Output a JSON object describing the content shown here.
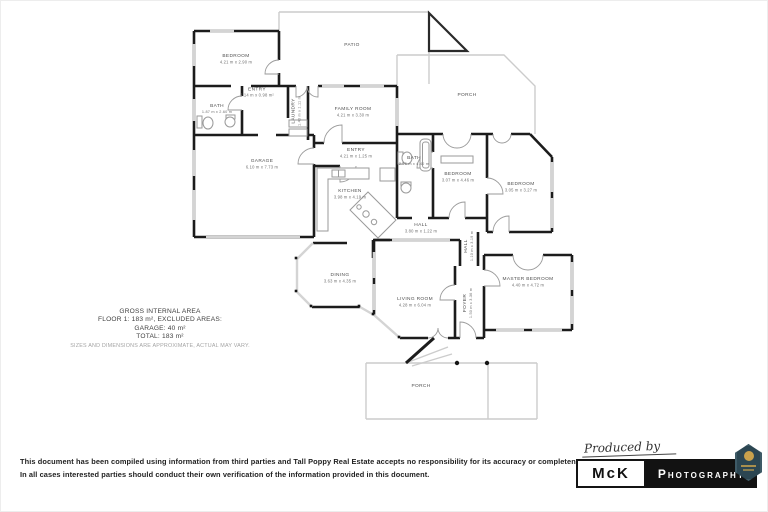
{
  "floorplan": {
    "rooms": [
      {
        "id": "bedroom-1",
        "name": "BEDROOM",
        "dims": "4.21 m x 2.90 m"
      },
      {
        "id": "entry-1",
        "name": "ENTRY",
        "dims": "2.14 m x 0.98 m²"
      },
      {
        "id": "bath-1",
        "name": "BATH",
        "dims": "1.87 m x 2.60 m"
      },
      {
        "id": "laundry",
        "name": "LAUNDRY",
        "dims": "1.40 m x 1.11 m"
      },
      {
        "id": "patio",
        "name": "PATIO",
        "dims": ""
      },
      {
        "id": "family-room",
        "name": "FAMILY ROOM",
        "dims": "4.21 m x 3.30 m"
      },
      {
        "id": "porch-top",
        "name": "PORCH",
        "dims": ""
      },
      {
        "id": "entry-2",
        "name": "ENTRY",
        "dims": "4.21 m x 1.25 m"
      },
      {
        "id": "garage",
        "name": "GARAGE",
        "dims": "6.10 m x 7.73 m"
      },
      {
        "id": "kitchen",
        "name": "KITCHEN",
        "dims": "3.98 m x 4.19 m"
      },
      {
        "id": "bath-2",
        "name": "BATH",
        "dims": "2.25 m x 4.40 m"
      },
      {
        "id": "bedroom-2",
        "name": "BEDROOM",
        "dims": "3.07 m x 4.46 m"
      },
      {
        "id": "bedroom-3",
        "name": "BEDROOM",
        "dims": "3.05 m x 3.27 m"
      },
      {
        "id": "hall-1",
        "name": "HALL",
        "dims": "3.80 m x 1.22 m"
      },
      {
        "id": "hall-2",
        "name": "HALL",
        "dims": "1.10 m x 3.19 m"
      },
      {
        "id": "dining",
        "name": "DINING",
        "dims": "3.63 m x 4.35 m"
      },
      {
        "id": "living-room",
        "name": "LIVING ROOM",
        "dims": "4.28 m x 6.04 m"
      },
      {
        "id": "foyer",
        "name": "FOYER",
        "dims": "1.50 m x 3.36 m"
      },
      {
        "id": "master-bedroom",
        "name": "MASTER BEDROOM",
        "dims": "4.40 m x 4.72 m"
      },
      {
        "id": "porch-bottom",
        "name": "PORCH",
        "dims": ""
      }
    ],
    "area_summary": {
      "title": "GROSS INTERNAL AREA",
      "floor": "FLOOR 1: 183 m², EXCLUDED AREAS:",
      "garage": "GARAGE: 40 m²",
      "total": "TOTAL: 183 m²",
      "note": "SIZES AND DIMENSIONS ARE APPROXIMATE, ACTUAL MAY VARY."
    },
    "colors": {
      "wall": "#1c1c1c",
      "window": "#d4d4d4",
      "outline": "#cccccc"
    }
  },
  "footer": {
    "disclaimer_line1": "This document has been compiled using information from third parties and Tall Poppy Real Estate accepts no responsibility for its accuracy or completeness.",
    "disclaimer_line2": "In all cases interested parties should conduct their own verification of the information provided in this document."
  },
  "branding": {
    "produced_by": "Produced by",
    "name_short": "McK",
    "name_rest": "Photography",
    "badge_icon": "crest-badge",
    "colors": {
      "box_black": "#121212",
      "badge_bg": "#2c4652",
      "badge_gold": "#c9a14c"
    }
  }
}
